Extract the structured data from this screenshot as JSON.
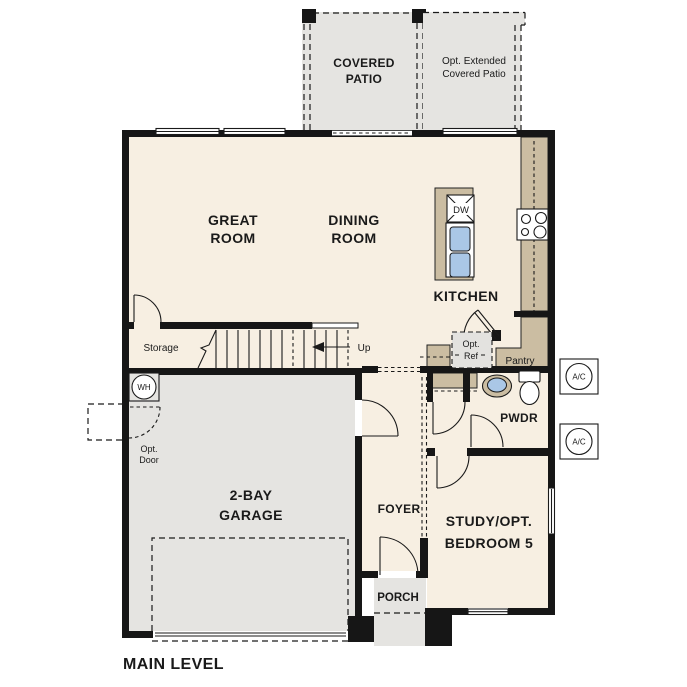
{
  "plan_title": "MAIN LEVEL",
  "rooms": {
    "covered_patio": {
      "line1": "COVERED",
      "line2": "PATIO"
    },
    "opt_extended_patio": {
      "line1": "Opt. Extended",
      "line2": "Covered Patio"
    },
    "great_room": {
      "line1": "GREAT",
      "line2": "ROOM"
    },
    "dining_room": {
      "line1": "DINING",
      "line2": "ROOM"
    },
    "kitchen": {
      "label": "KITCHEN"
    },
    "pantry": {
      "label": "Pantry"
    },
    "powder_room": {
      "label": "PWDR"
    },
    "storage": {
      "label": "Storage"
    },
    "stairs": {
      "label": "Up"
    },
    "garage": {
      "line1": "2-BAY",
      "line2": "GARAGE"
    },
    "foyer": {
      "label": "FOYER"
    },
    "porch": {
      "label": "PORCH"
    },
    "study": {
      "line1": "STUDY/OPT.",
      "line2": "BEDROOM 5"
    }
  },
  "fixtures": {
    "dishwasher": {
      "label": "DW"
    },
    "water_heater": {
      "label": "WH"
    },
    "ac_unit_1": {
      "label": "A/C"
    },
    "ac_unit_2": {
      "label": "A/C"
    },
    "opt_refrigerator": {
      "line1": "Opt.",
      "line2": "Ref"
    },
    "opt_door": {
      "line1": "Opt.",
      "line2": "Door"
    }
  },
  "colors": {
    "floor": "#f7efe2",
    "patio_and_garage": "#e5e4e1",
    "counter_tan": "#cbbda2",
    "sink_blue": "#aac7e6",
    "wall_black": "#161616",
    "text": "#1a1a1a"
  }
}
